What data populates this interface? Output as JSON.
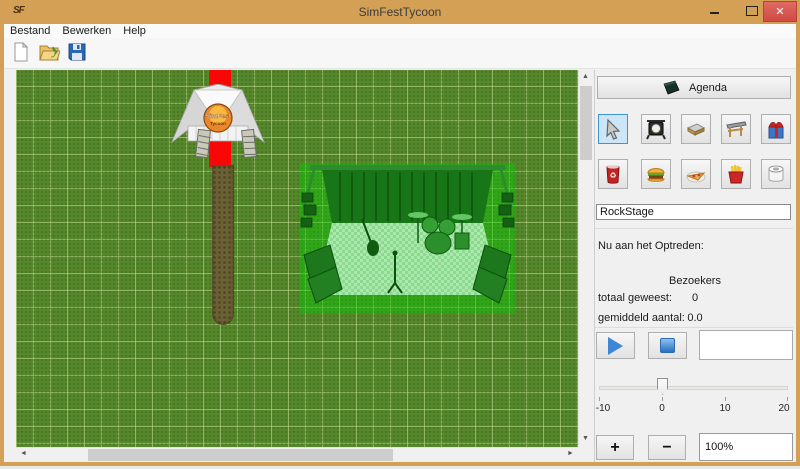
{
  "window": {
    "title": "SimFestTycoon",
    "icon_text": "SF",
    "minimize_glyph": "",
    "close_glyph": "✕"
  },
  "menu": {
    "items": [
      {
        "label": "Bestand"
      },
      {
        "label": "Bewerken"
      },
      {
        "label": "Help"
      }
    ]
  },
  "toolbar": {
    "buttons": [
      {
        "name": "new-file",
        "icon": "new-document-icon"
      },
      {
        "name": "open-file",
        "icon": "open-folder-icon"
      },
      {
        "name": "save-file",
        "icon": "save-floppy-icon"
      }
    ]
  },
  "canvas": {
    "objects": {
      "entrance_tent": "SimFest entrance tent",
      "red_carpet": "red entrance carpet",
      "dirt_path": "dirt path",
      "stage_preview": "RockStage (green placement highlight)"
    }
  },
  "panel": {
    "agenda": {
      "label": "Agenda",
      "icon": "agenda-book-icon"
    },
    "tools": [
      {
        "name": "select",
        "icon": "cursor-icon",
        "selected": true
      },
      {
        "name": "spotlight",
        "icon": "spotlight-icon"
      },
      {
        "name": "stage",
        "icon": "stage-platform-icon"
      },
      {
        "name": "entrance",
        "icon": "entrance-gate-icon"
      },
      {
        "name": "gift",
        "icon": "gift-box-icon"
      }
    ],
    "items": [
      {
        "name": "drinks",
        "icon": "drink-can-icon"
      },
      {
        "name": "burger",
        "icon": "burger-icon"
      },
      {
        "name": "pizza",
        "icon": "pizza-icon"
      },
      {
        "name": "fries",
        "icon": "fries-icon"
      },
      {
        "name": "toilet",
        "icon": "toilet-roll-icon"
      }
    ],
    "name_field": {
      "value": "RockStage"
    },
    "now_playing_label": "Nu aan het Optreden:",
    "stats": {
      "header": "Bezoekers",
      "rows": [
        {
          "label": "totaal geweest:",
          "value": "0"
        },
        {
          "label": "gemiddeld aantal:",
          "value": "0.0"
        }
      ]
    },
    "slider": {
      "min": -10,
      "max": 20,
      "value": 0,
      "tick_labels": [
        "-10",
        "0",
        "10",
        "20"
      ]
    },
    "zoom": {
      "plus": "+",
      "minus": "−",
      "level": "100%"
    }
  },
  "colors": {
    "titlebar": "#d3a055",
    "close_button": "#d9534f",
    "selected_tool_bg": "#cde6f7",
    "selected_tool_border": "#3c94d6",
    "grass": "#57882c",
    "grid_line": "#a9c97f",
    "carpet": "#f90606",
    "path": "#6c6134",
    "stage_tint": "rgba(0,205,0,0.42)"
  }
}
